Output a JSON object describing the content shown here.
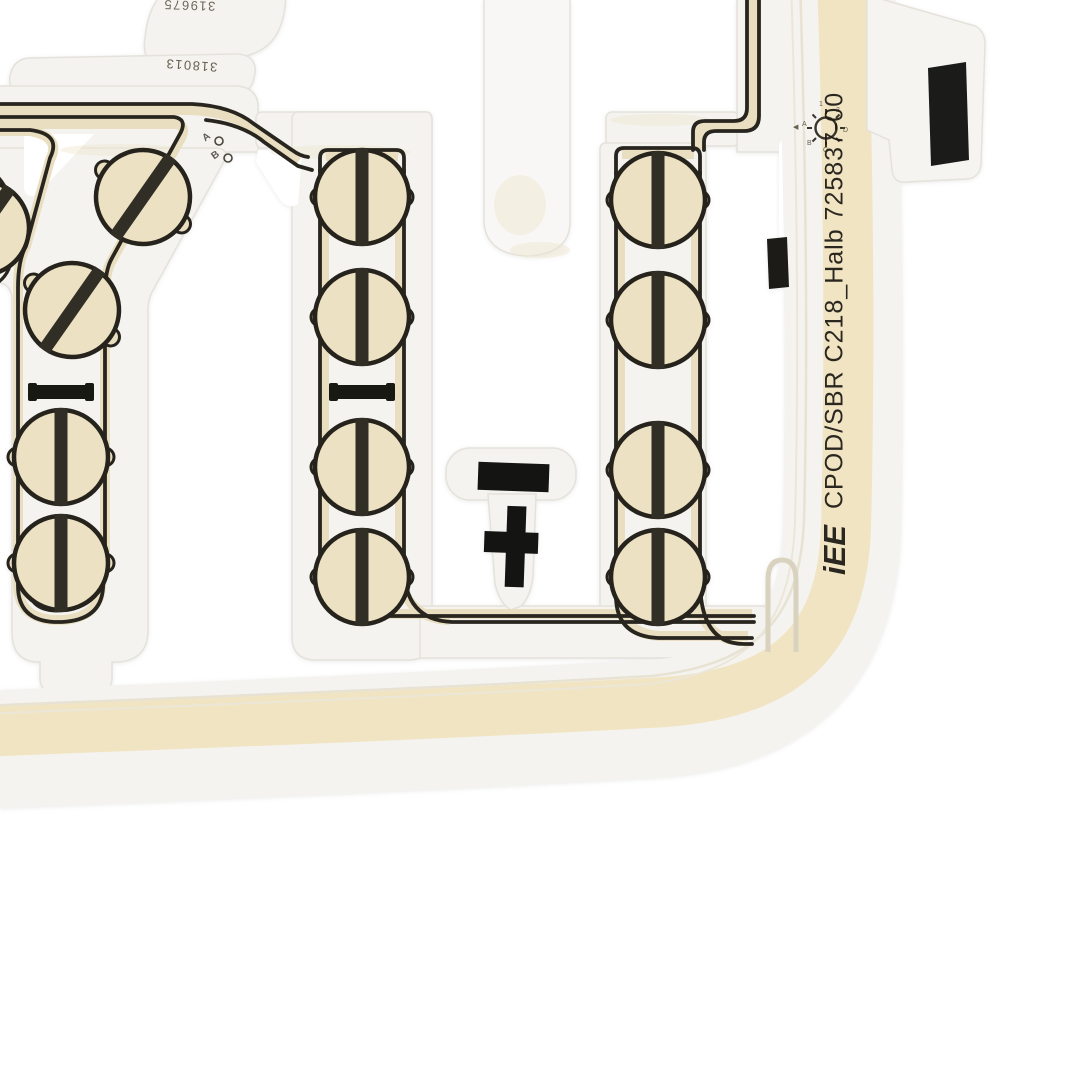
{
  "photo": {
    "description": "Flexible printed-film seat occupancy sensor mat (membrane circuit) photographed on white background",
    "background_color": "#ffffff",
    "film_color": "#f4f3f0",
    "pad_color": "#ece1c2",
    "rail_fill_color": "#e9dec0",
    "trace_color": "#28251f",
    "beige_strip_color": "#f1e4c2",
    "mark_color": "#161512",
    "part_label": {
      "brand": "iEE",
      "text": "CPOD/SBR C218_Halb 725837-00"
    },
    "serials": {
      "top": "319675",
      "lower": "318013"
    },
    "junction": {
      "a": "A",
      "b": "B"
    },
    "calibration": {
      "icon": "sun-calibration-mark",
      "pointer": "◀",
      "letters": [
        "A",
        "B",
        "C",
        "D",
        "1",
        "2"
      ]
    },
    "printed_symbols": {
      "polarity_minus": "minus-bar-mark",
      "polarity_plus": "plus-cross-mark",
      "black_tab": "black-rectangle-marker",
      "small_black_patch": "black-rectangle-marker-small",
      "resistor_marks": "notched-minus-bar between cells (left and middle columns)"
    },
    "sensor_cells": {
      "left_diagonal_chain": 2,
      "left_column": 2,
      "middle_column": 4,
      "right_column": 4,
      "edge_partial_cell": 1
    }
  }
}
